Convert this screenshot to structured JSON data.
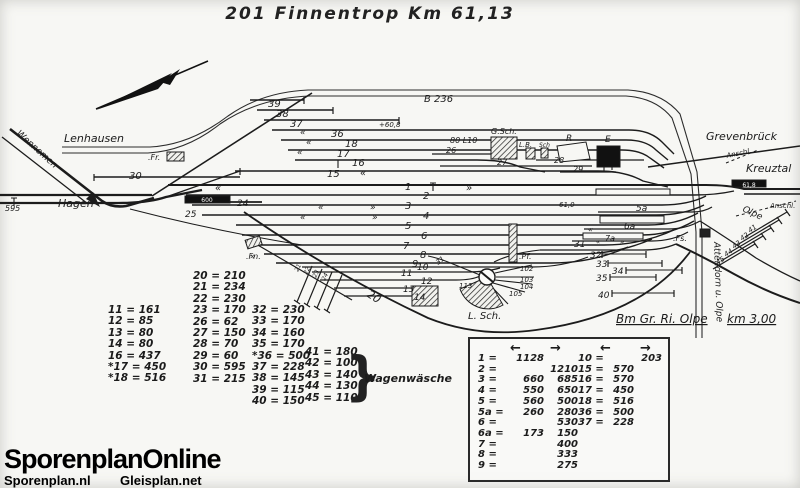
{
  "title": "201 Finnentrop  Km 61,13",
  "logo": {
    "main": "SporenplanOnline",
    "left": "Sporenplan.nl",
    "right": "Gleisplan.net"
  },
  "left_table": {
    "col1": [
      "11 = 161",
      "12 = 85",
      "13 = 80",
      "14 = 80",
      "16 = 437",
      "*17 = 450",
      "*18 = 516"
    ],
    "col2": [
      "20 = 210",
      "21 = 234",
      "22 = 230",
      "23 = 170",
      "26 = 62",
      "27 = 150",
      "28 = 70",
      "29 = 60",
      "30 = 595",
      "31 = 215"
    ],
    "col3": [
      "32 = 230",
      "33 = 170",
      "34 = 160",
      "35 = 170",
      "*36 = 500",
      "37 = 228",
      "38 = 145",
      "39 = 115",
      "40 = 150"
    ],
    "col4": [
      "41 = 180",
      "42 = 100",
      "43 = 140",
      "44 = 130",
      "45 = 110"
    ],
    "brace": "}",
    "note": "Wagenwäsche"
  },
  "box_table": {
    "arrows": [
      "←",
      "→",
      "←",
      "→"
    ],
    "left_rows": [
      {
        "t": "1 =",
        "a": "1128",
        "b": ""
      },
      {
        "t": "2 =",
        "a": "",
        "b": "1210"
      },
      {
        "t": "3 =",
        "a": "660",
        "b": "685"
      },
      {
        "t": "4 =",
        "a": "550",
        "b": "650"
      },
      {
        "t": "5 =",
        "a": "560",
        "b": "500"
      },
      {
        "t": "5a =",
        "a": "260",
        "b": "280"
      },
      {
        "t": "6 =",
        "a": "",
        "b": "530"
      },
      {
        "t": "6a =",
        "a": "173",
        "b": "150"
      },
      {
        "t": "7 =",
        "a": "",
        "b": "400"
      },
      {
        "t": "8 =",
        "a": "",
        "b": "333"
      },
      {
        "t": "9 =",
        "a": "",
        "b": "275"
      }
    ],
    "right_rows": [
      {
        "t": "10 =",
        "a": "",
        "b": "203"
      },
      {
        "t": "15 =",
        "a": "570",
        "b": ""
      },
      {
        "t": "16 =",
        "a": "570",
        "b": ""
      },
      {
        "t": "17 =",
        "a": "450",
        "b": ""
      },
      {
        "t": "18 =",
        "a": "516",
        "b": ""
      },
      {
        "t": "36 =",
        "a": "500",
        "b": ""
      },
      {
        "t": "37 =",
        "a": "228",
        "b": ""
      }
    ]
  },
  "diagram": {
    "labels": [
      {
        "n": "lenhausen-label",
        "t": "Lenhausen",
        "x": 64,
        "y": 142,
        "s": 11
      },
      {
        "n": "wennemen-label",
        "t": "Wennemen",
        "x": 16,
        "y": 134,
        "s": 9,
        "r": 42
      },
      {
        "n": "hagen-label",
        "t": "Hagen",
        "x": 58,
        "y": 207,
        "s": 11
      },
      {
        "n": "grevenbrueck-label",
        "t": "Grevenbrück",
        "x": 706,
        "y": 140,
        "s": 11
      },
      {
        "n": "kreuztal-label",
        "t": "Kreuztal",
        "x": 746,
        "y": 172,
        "s": 11
      },
      {
        "n": "olpe-label",
        "t": "Olpe",
        "x": 742,
        "y": 211,
        "s": 9,
        "r": 25
      },
      {
        "n": "anschl-top-label",
        "t": "Anschl.",
        "x": 727,
        "y": 158,
        "s": 7,
        "r": -12
      },
      {
        "n": "anschl-right-label",
        "t": "Anschl.",
        "x": 770,
        "y": 208,
        "s": 7
      },
      {
        "n": "b236-label",
        "t": "B 236",
        "x": 424,
        "y": 102,
        "s": 10
      },
      {
        "n": "attendorn-olpe-label",
        "t": "Attendorn u. Olpe",
        "x": 714,
        "y": 242,
        "s": 9,
        "r": 88
      },
      {
        "n": "bm-gr-ri-olpe-label",
        "t": "Bm Gr. Ri. Olpe",
        "x": 616,
        "y": 323,
        "s": 12,
        "c": "u"
      },
      {
        "n": "km-3-00-label",
        "t": "km 3,00",
        "x": 727,
        "y": 323,
        "s": 12,
        "c": "u"
      },
      {
        "n": "gueterschuppen-label",
        "t": "G.Sch.",
        "x": 491,
        "y": 134,
        "s": 8
      },
      {
        "n": "lb-building-label",
        "t": "L.B.",
        "x": 519,
        "y": 147,
        "s": 7
      },
      {
        "n": "sch-building-label",
        "t": "Sch",
        "x": 539,
        "y": 147,
        "s": 6
      },
      {
        "n": "r-building-label",
        "t": "R",
        "x": 566,
        "y": 141,
        "s": 9
      },
      {
        "n": "empfangsgebaeude-label",
        "t": "E",
        "x": 605,
        "y": 142,
        "s": 9
      },
      {
        "n": "lokschuppen-label",
        "t": "L. Sch.",
        "x": 468,
        "y": 319,
        "s": 10
      },
      {
        "n": "stellwerk-fr-label",
        "t": ".Fr.",
        "x": 148,
        "y": 160,
        "s": 8
      },
      {
        "n": "stellwerk-fn-label",
        "t": ".Fn.",
        "x": 246,
        "y": 259,
        "s": 8
      },
      {
        "n": "stellwerk-pf-label",
        "t": ".Pf.",
        "x": 519,
        "y": 259,
        "s": 8
      },
      {
        "n": "stellwerk-fs-label",
        "t": ".Fs.",
        "x": 673,
        "y": 241,
        "s": 8
      },
      {
        "n": "km-595-marker",
        "t": "595",
        "x": 5,
        "y": 211,
        "s": 8
      },
      {
        "n": "km-60-8-marker",
        "t": "+60,8",
        "x": 379,
        "y": 127,
        "s": 7
      },
      {
        "n": "km-61-0-marker",
        "t": "61,0",
        "x": 559,
        "y": 207,
        "s": 7
      },
      {
        "n": "km-61-8-marker",
        "t": "61,8",
        "x": 749,
        "y": 187,
        "s": 6,
        "c": "wh mid"
      },
      {
        "n": "platform-600-marker",
        "t": "600",
        "x": 207,
        "y": 202,
        "s": 6,
        "c": "wh mid"
      },
      {
        "n": "km-80-l10-marker",
        "t": "80 L10",
        "x": 450,
        "y": 143,
        "s": 8
      },
      {
        "n": "track-39",
        "t": "39",
        "x": 268,
        "y": 107,
        "s": 10
      },
      {
        "n": "track-38",
        "t": "38",
        "x": 276,
        "y": 117,
        "s": 10
      },
      {
        "n": "track-37",
        "t": "37",
        "x": 290,
        "y": 127,
        "s": 10
      },
      {
        "n": "track-36",
        "t": "36",
        "x": 331,
        "y": 137,
        "s": 10
      },
      {
        "n": "track-18",
        "t": "18",
        "x": 345,
        "y": 147,
        "s": 10
      },
      {
        "n": "track-17",
        "t": "17",
        "x": 337,
        "y": 157,
        "s": 10
      },
      {
        "n": "track-16",
        "t": "16",
        "x": 352,
        "y": 166,
        "s": 10
      },
      {
        "n": "track-15",
        "t": "15",
        "x": 327,
        "y": 177,
        "s": 10
      },
      {
        "n": "track-1",
        "t": "1",
        "x": 405,
        "y": 190,
        "s": 10
      },
      {
        "n": "track-2",
        "t": "2",
        "x": 423,
        "y": 199,
        "s": 10
      },
      {
        "n": "track-3",
        "t": "3",
        "x": 405,
        "y": 209,
        "s": 10
      },
      {
        "n": "track-4",
        "t": "4",
        "x": 423,
        "y": 219,
        "s": 10
      },
      {
        "n": "track-5",
        "t": "5",
        "x": 405,
        "y": 229,
        "s": 10
      },
      {
        "n": "track-6",
        "t": "6",
        "x": 421,
        "y": 239,
        "s": 10
      },
      {
        "n": "track-7",
        "t": "7",
        "x": 403,
        "y": 249,
        "s": 10
      },
      {
        "n": "track-8",
        "t": "8",
        "x": 420,
        "y": 258,
        "s": 10
      },
      {
        "n": "track-9",
        "t": "9",
        "x": 412,
        "y": 267,
        "s": 10
      },
      {
        "n": "track-10",
        "t": "10",
        "x": 417,
        "y": 270,
        "s": 9
      },
      {
        "n": "track-11",
        "t": "11",
        "x": 401,
        "y": 276,
        "s": 9
      },
      {
        "n": "track-12",
        "t": "12",
        "x": 421,
        "y": 284,
        "s": 9
      },
      {
        "n": "track-13",
        "t": "13",
        "x": 403,
        "y": 292,
        "s": 9
      },
      {
        "n": "track-14",
        "t": "14",
        "x": 414,
        "y": 300,
        "s": 9
      },
      {
        "n": "track-30",
        "t": "30",
        "x": 129,
        "y": 179,
        "s": 10
      },
      {
        "n": "track-24",
        "t": "24",
        "x": 237,
        "y": 206,
        "s": 9
      },
      {
        "n": "track-25",
        "t": "25",
        "x": 185,
        "y": 217,
        "s": 9
      },
      {
        "n": "track-20",
        "t": "20",
        "x": 366,
        "y": 296,
        "s": 11,
        "r": 33
      },
      {
        "n": "track-21",
        "t": "21",
        "x": 298,
        "y": 272,
        "s": 6,
        "r": -65
      },
      {
        "n": "track-22",
        "t": "22",
        "x": 307,
        "y": 275,
        "s": 6,
        "r": -65
      },
      {
        "n": "track-23",
        "t": "23",
        "x": 316,
        "y": 278,
        "s": 6,
        "r": -65
      },
      {
        "n": "track-24b",
        "t": "24",
        "x": 325,
        "y": 281,
        "s": 6,
        "r": -65
      },
      {
        "n": "track-26",
        "t": "26",
        "x": 446,
        "y": 153,
        "s": 8
      },
      {
        "n": "track-27",
        "t": "27",
        "x": 497,
        "y": 165,
        "s": 8
      },
      {
        "n": "track-28",
        "t": "28",
        "x": 554,
        "y": 163,
        "s": 8
      },
      {
        "n": "track-29",
        "t": "29",
        "x": 573,
        "y": 172,
        "s": 8
      },
      {
        "n": "track-31",
        "t": "31",
        "x": 574,
        "y": 247,
        "s": 9
      },
      {
        "n": "track-32",
        "t": "32",
        "x": 590,
        "y": 258,
        "s": 9
      },
      {
        "n": "track-33",
        "t": "33",
        "x": 596,
        "y": 267,
        "s": 9
      },
      {
        "n": "track-34",
        "t": "34",
        "x": 612,
        "y": 274,
        "s": 9
      },
      {
        "n": "track-35",
        "t": "35",
        "x": 596,
        "y": 281,
        "s": 9
      },
      {
        "n": "track-40",
        "t": "40",
        "x": 598,
        "y": 298,
        "s": 9
      },
      {
        "n": "track-5a",
        "t": "5a",
        "x": 636,
        "y": 211,
        "s": 9
      },
      {
        "n": "track-6a",
        "t": "6a",
        "x": 624,
        "y": 229,
        "s": 9
      },
      {
        "n": "track-7a",
        "t": "7a",
        "x": 605,
        "y": 241,
        "s": 8
      },
      {
        "n": "track-41",
        "t": "41",
        "x": 750,
        "y": 233,
        "s": 7,
        "r": -35
      },
      {
        "n": "track-42",
        "t": "42",
        "x": 742,
        "y": 241,
        "s": 7,
        "r": -35
      },
      {
        "n": "track-43",
        "t": "43",
        "x": 734,
        "y": 249,
        "s": 7,
        "r": -35
      },
      {
        "n": "track-44",
        "t": "44",
        "x": 726,
        "y": 257,
        "s": 7,
        "r": -35
      },
      {
        "n": "track-45",
        "t": "45",
        "x": 718,
        "y": 265,
        "s": 7,
        "r": -35
      },
      {
        "n": "track-102",
        "t": "102",
        "x": 520,
        "y": 271,
        "s": 7
      },
      {
        "n": "track-103",
        "t": "103",
        "x": 520,
        "y": 282,
        "s": 7
      },
      {
        "n": "track-104",
        "t": "104",
        "x": 520,
        "y": 289,
        "s": 7
      },
      {
        "n": "track-105",
        "t": "105",
        "x": 509,
        "y": 296,
        "s": 7
      },
      {
        "n": "turntable-113",
        "t": "113",
        "x": 459,
        "y": 288,
        "s": 7
      },
      {
        "n": "track-31-diagonal",
        "t": "31",
        "x": 438,
        "y": 265,
        "s": 7,
        "r": -38
      },
      {
        "n": "direction-chevron",
        "t": "«",
        "x": 300,
        "y": 135,
        "s": 9
      },
      {
        "n": "direction-chevron",
        "t": "«",
        "x": 306,
        "y": 145,
        "s": 9
      },
      {
        "n": "direction-chevron",
        "t": "«",
        "x": 297,
        "y": 155,
        "s": 9
      },
      {
        "n": "direction-chevron",
        "t": "«",
        "x": 360,
        "y": 176,
        "s": 10
      },
      {
        "n": "direction-chevron",
        "t": "«",
        "x": 215,
        "y": 191,
        "s": 10
      },
      {
        "n": "direction-chevron",
        "t": "»",
        "x": 466,
        "y": 191,
        "s": 10
      },
      {
        "n": "direction-chevron",
        "t": "«",
        "x": 318,
        "y": 210,
        "s": 9
      },
      {
        "n": "direction-chevron",
        "t": "»",
        "x": 370,
        "y": 210,
        "s": 9
      },
      {
        "n": "direction-chevron",
        "t": "«",
        "x": 300,
        "y": 220,
        "s": 9
      },
      {
        "n": "direction-chevron",
        "t": "»",
        "x": 372,
        "y": 220,
        "s": 9
      },
      {
        "n": "direction-chevron",
        "t": "»",
        "x": 250,
        "y": 259,
        "s": 9
      },
      {
        "n": "direction-chevron",
        "t": "«",
        "x": 588,
        "y": 232,
        "s": 8
      },
      {
        "n": "direction-chevron",
        "t": "«",
        "x": 596,
        "y": 244,
        "s": 7
      },
      {
        "n": "direction-chevron",
        "t": "»",
        "x": 620,
        "y": 244,
        "s": 7
      }
    ]
  }
}
